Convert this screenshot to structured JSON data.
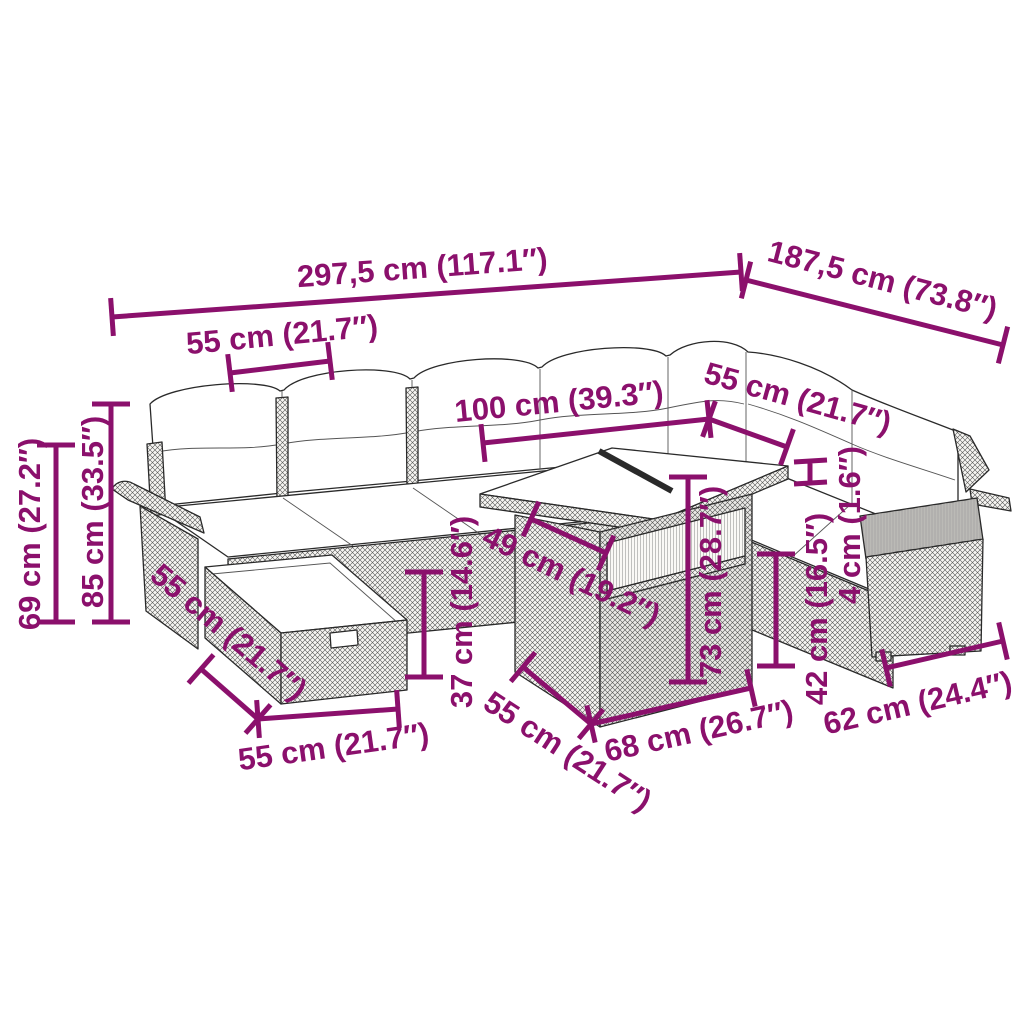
{
  "style": {
    "dimension_color": "#8B106C",
    "drawing_line_color": "#2a2a2a",
    "background_color": "#ffffff"
  },
  "diagram": {
    "kind": "furniture-dimensions",
    "subject": "rattan-garden-lounge-set"
  },
  "dimensions": [
    {
      "id": "total-width",
      "label": "297,5 cm (117.1″)",
      "line": [
        112,
        317,
        741,
        272
      ],
      "label_pos": [
        423,
        278,
        -4.2
      ]
    },
    {
      "id": "total-depth",
      "label": "187,5 cm (73.8″)",
      "line": [
        746,
        280,
        1003,
        345
      ],
      "label_pos": [
        880,
        290,
        14.5
      ]
    },
    {
      "id": "seat-width-left",
      "label": "55 cm (21.7″)",
      "line": [
        230,
        373,
        330,
        361
      ],
      "label_pos": [
        283,
        345,
        -5.5
      ]
    },
    {
      "id": "table-length-top",
      "label": "100 cm (39.3″)",
      "line": [
        483,
        443,
        709,
        419
      ],
      "label_pos": [
        560,
        412,
        -5.5
      ]
    },
    {
      "id": "seat-width-right",
      "label": "55 cm (21.7″)",
      "line": [
        709,
        419,
        787,
        447
      ],
      "label_pos": [
        795,
        408,
        15.5
      ]
    },
    {
      "id": "back-height",
      "label": "69 cm (27.2″)",
      "line": [
        56,
        445,
        56,
        622
      ],
      "label_pos": [
        40,
        534,
        -90
      ]
    },
    {
      "id": "total-height",
      "label": "85 cm (33.5″)",
      "line": [
        111,
        404,
        111,
        622
      ],
      "label_pos": [
        103,
        512,
        -90
      ]
    },
    {
      "id": "ottoman-depth",
      "label": "55 cm (21.7″)",
      "line": [
        201,
        669,
        258,
        719
      ],
      "label_pos": [
        222,
        640,
        40
      ]
    },
    {
      "id": "ottoman-width",
      "label": "55 cm (21.7″)",
      "line": [
        258,
        719,
        398,
        709
      ],
      "label_pos": [
        335,
        757,
        -8
      ]
    },
    {
      "id": "ottoman-height",
      "label": "37 cm (14.6″)",
      "line": [
        424,
        572,
        424,
        677
      ],
      "label_pos": [
        472,
        612,
        -90
      ]
    },
    {
      "id": "glass-panel-width",
      "label": "49 cm (19.2″)",
      "line": [
        531,
        519,
        606,
        553
      ],
      "label_pos": [
        567,
        585,
        25.5
      ]
    },
    {
      "id": "table-height",
      "label": "73 cm (28.7″)",
      "line": [
        688,
        477,
        688,
        682
      ],
      "label_pos": [
        721,
        582,
        -90
      ]
    },
    {
      "id": "table-depth",
      "label": "55 cm (21.7″)",
      "line": [
        523,
        667,
        591,
        724
      ],
      "label_pos": [
        562,
        760,
        33
      ]
    },
    {
      "id": "table-width",
      "label": "68 cm (26.7″)",
      "line": [
        591,
        724,
        751,
        688
      ],
      "label_pos": [
        701,
        741,
        -12.5
      ]
    },
    {
      "id": "seat-height",
      "label": "42 cm (16.5″)",
      "line": [
        776,
        554,
        776,
        666
      ],
      "label_pos": [
        827,
        609,
        -90
      ]
    },
    {
      "id": "glass-thickness",
      "label": "4 cm (1.6″)",
      "line": null,
      "label_pos": [
        860,
        525,
        -90
      ]
    },
    {
      "id": "armchair-depth",
      "label": "62 cm (24.4″)",
      "line": [
        886,
        668,
        1003,
        641
      ],
      "label_pos": [
        920,
        713,
        -13
      ]
    }
  ]
}
